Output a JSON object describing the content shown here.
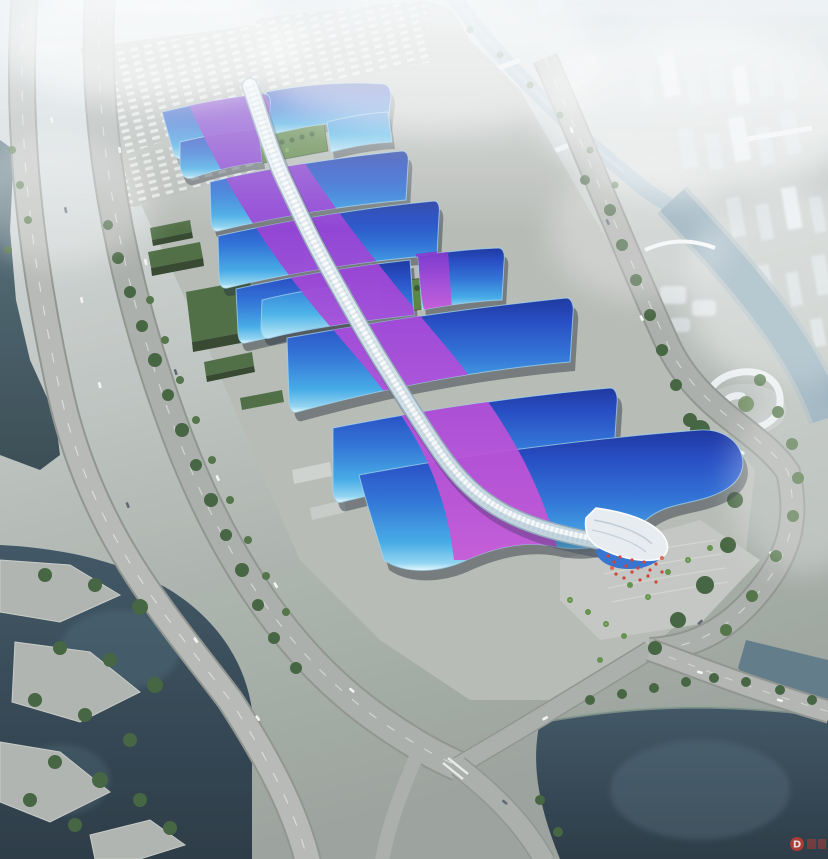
{
  "meta": {
    "domain": "Natural-Image",
    "description": "Photorealistic aerial bird's-eye rendering of a riverside exhibition and convention center: seven rows of wave-edged exhibition halls with blue metal roofs swept by a magenta-violet ribbon motif, joined by a sinuous pale gridshell concourse spine ending in a white wave-crest entrance canopy, surrounded by concrete aprons, truck lots, tree-lined roads, canals, dark water basins and a hazy white high-rise city.",
    "time_of_day": "daytime, strong atmospheric haze",
    "view": "oblique aerial from the south-west"
  },
  "scene": {
    "complex": {
      "hall_rows_visible": 7,
      "roof_style": "curved wave-edge roofs with bright cyan eaves",
      "roof_motif": "purple-magenta ribbon sweeping an S-curve across the blue roofs",
      "spine": "serpentine white-blue diamond-grid concourse running the full length",
      "south_entrance": "white wave-crest canopy over an entrance plaza with red banners and palm trees",
      "green_courtyards": 2
    },
    "context": {
      "waterways": [
        "canal winding through the northern city blocks",
        "river along the east side",
        "dark basin at the south-east",
        "lake with terraced park at the south-west",
        "narrow channel along the west edge"
      ],
      "roads": [
        "elevated expressway along the west edge",
        "tree-lined boulevard beside the complex",
        "curving eastern ring road around the entrance",
        "southern bridge roads meeting at an intersection"
      ],
      "parking": "truck and car marshalling lots at the north-west corner",
      "city": "hazy white high-rise district to the north and east",
      "landmark": "white spiral-roof pavilion east of the entrance plaza"
    },
    "watermark": {
      "letter": "D",
      "color": "#c0392b",
      "position": "bottom-right",
      "note": "small red logo, characters illegible"
    }
  },
  "palette": {
    "fog": "#edf2f5",
    "ground-north": "#d9dfe3",
    "ground-south": "#9aa29c",
    "concrete-apron": "#b6bab5",
    "road": "#a9ada9",
    "roof-blue-deep": "#16309c",
    "roof-blue": "#2a6fd6",
    "roof-cyan": "#3fa9e6",
    "roof-rim": "#dff2fb",
    "ribbon-violet": "#7e30cc",
    "ribbon-magenta": "#cc4fd4",
    "spine-light": "#eef4f8",
    "spine-shade": "#b9cedb",
    "water-dark": "#2e414c",
    "water-teal": "#50707d",
    "water-river": "#7e9dad",
    "tree-green": "#3f5f3a",
    "lawn-green": "#56803e",
    "shed-roof-green": "#4a6a40",
    "red-accent": "#d23b2f",
    "city-block": "#d4dbdf"
  }
}
